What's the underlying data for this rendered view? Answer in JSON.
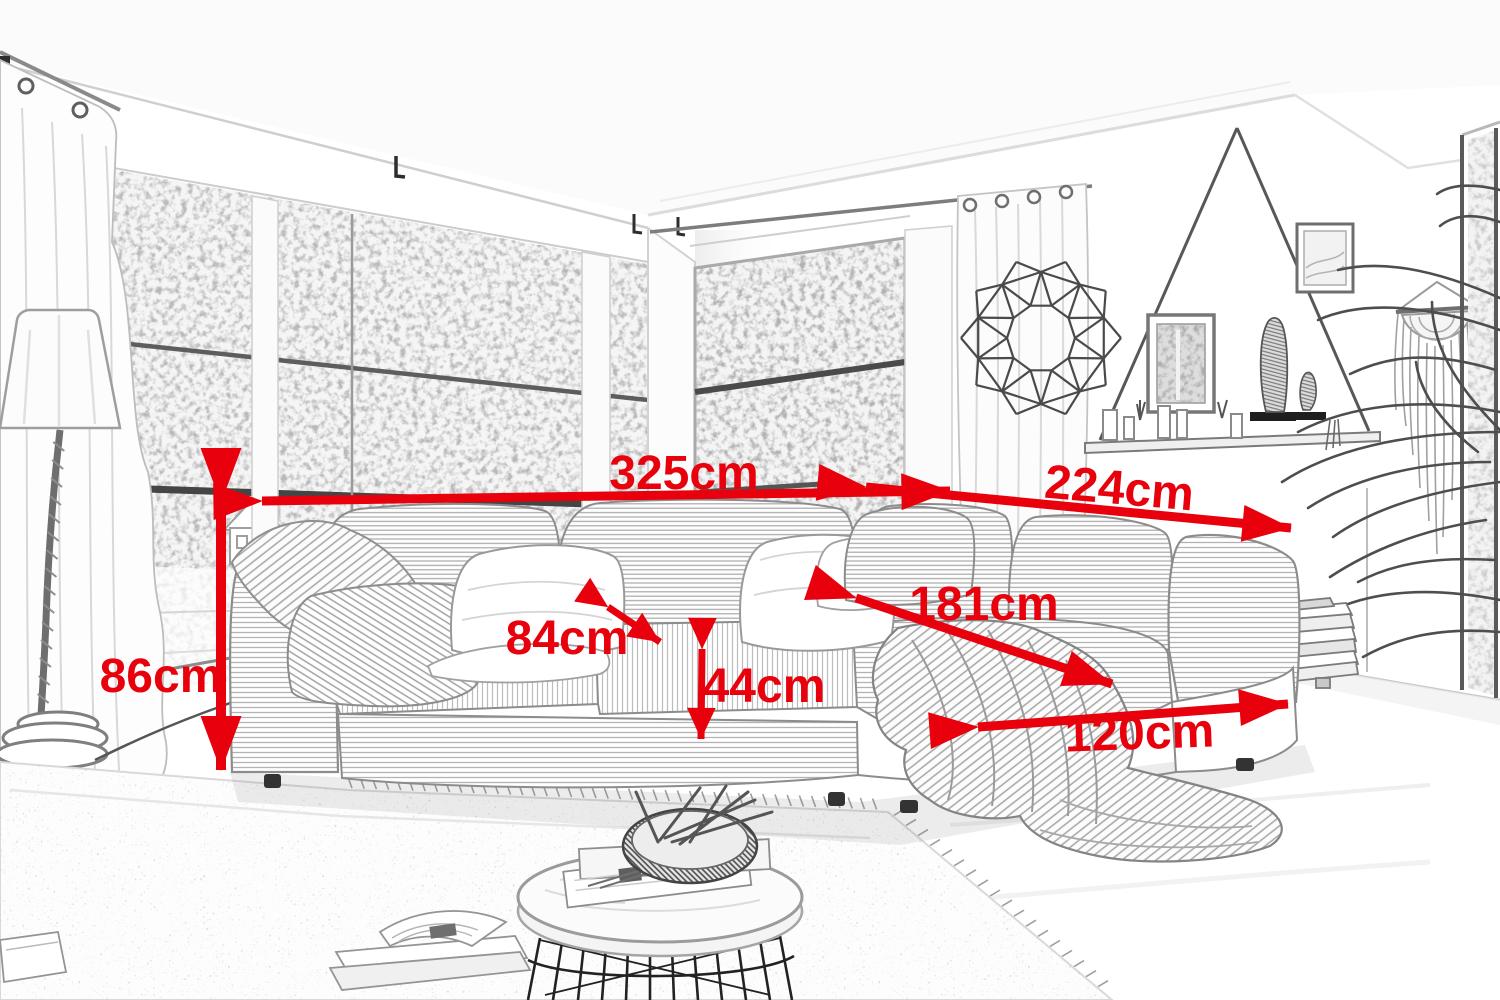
{
  "meta": {
    "title": "Corner sofa with chaise — dimension sketch",
    "style": "hand-drawn pencil sketch of a living room with red measurement arrows",
    "unit": "cm",
    "accent_color": "#e8000d",
    "sketch_color": "#8c8c8c"
  },
  "dimensions": {
    "sofa_total_width": {
      "label": "325cm",
      "value": 325
    },
    "sofa_total_depth": {
      "label": "224cm",
      "value": 224
    },
    "back_height": {
      "label": "86cm",
      "value": 86
    },
    "seat_depth": {
      "label": "84cm",
      "value": 84
    },
    "seat_height": {
      "label": "44cm",
      "value": 44
    },
    "chaise_length": {
      "label": "181cm",
      "value": 181
    },
    "chaise_width": {
      "label": "120cm",
      "value": 120
    }
  }
}
